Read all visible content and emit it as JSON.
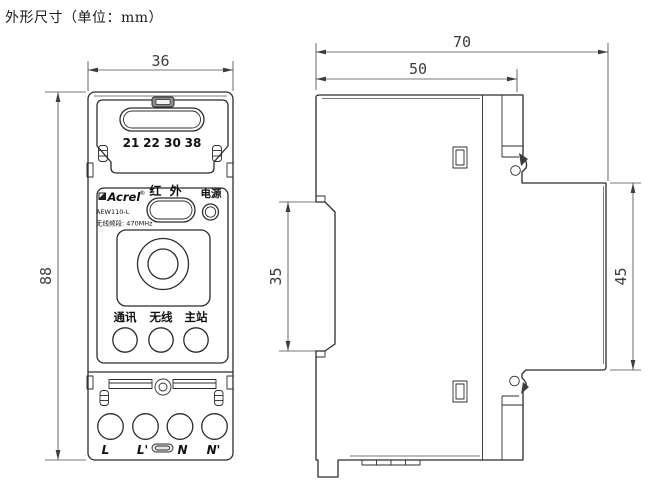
{
  "page": {
    "title": "外形尺寸（单位：mm）"
  },
  "front_view": {
    "dim_width": "36",
    "dim_height": "88",
    "terminal_numbers": [
      "21",
      "22",
      "30",
      "38"
    ],
    "brand": "Acrel",
    "reg_mark": "®",
    "model": "AEW110-L",
    "frequency_note": "无线频段: 470MHz",
    "infrared_label": "红 外",
    "power_label": "电源",
    "led_labels": [
      "通讯",
      "无线",
      "主站"
    ],
    "terminal_labels": [
      "L",
      "L'",
      "N",
      "N'"
    ]
  },
  "side_view": {
    "dim_total_depth": "70",
    "dim_body_depth": "50",
    "dim_rail_slot": "35",
    "dim_rear_height": "45"
  }
}
